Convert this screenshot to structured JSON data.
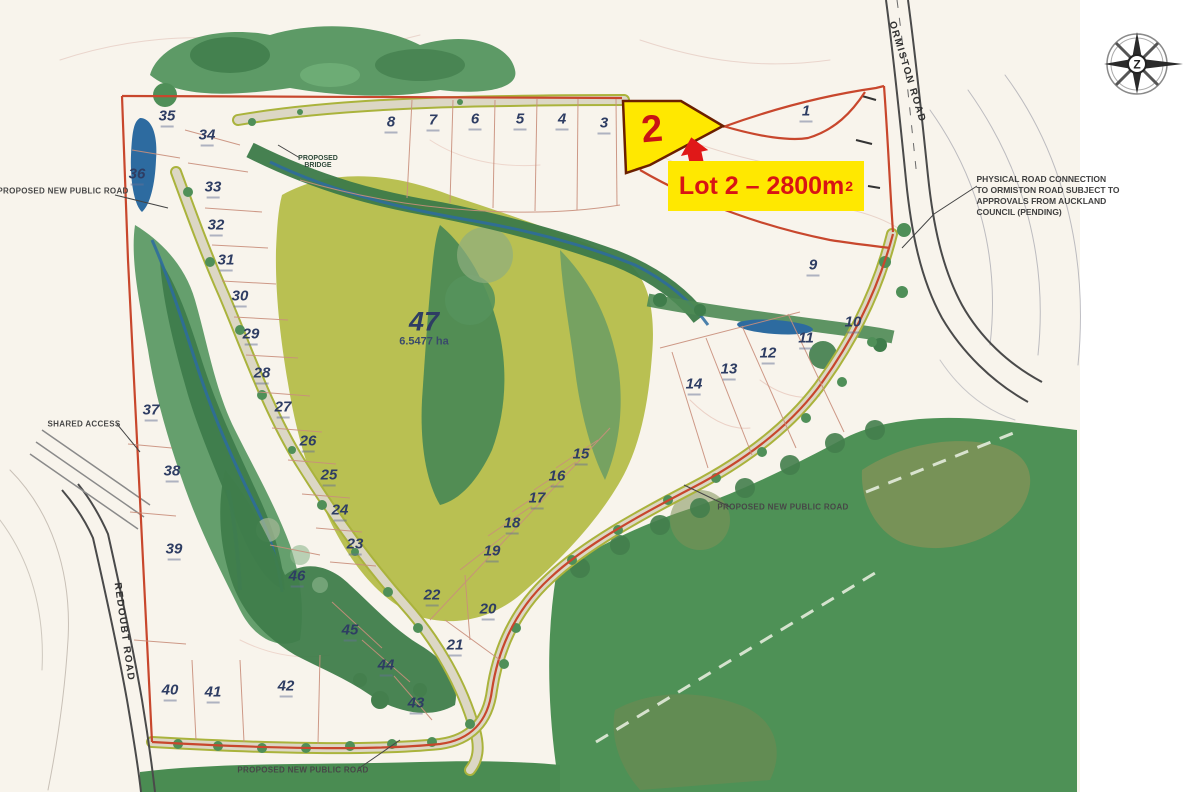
{
  "colors": {
    "paper": "#f8f4ec",
    "boundary_red": "#c8472d",
    "lot_number_navy": "#2e3d63",
    "highlight_yellow": "#ffe800",
    "highlight_red": "#d81414",
    "open_space_olive": "#b9c052",
    "forest_green": "#4e9156",
    "water_blue": "#2d6ba0",
    "road_tan": "#dcd7c5",
    "road_edge_olive": "#aab33c"
  },
  "compass": {
    "center_letter": "Z"
  },
  "highlight": {
    "number": "2",
    "label_text": "Lot 2 – 2800m",
    "label_sup": "2"
  },
  "map_labels": [
    {
      "text": "PROPOSED NEW PUBLIC ROAD",
      "x": 63,
      "y": 191,
      "cls": "tiny"
    },
    {
      "text": "SHARED ACCESS",
      "x": 84,
      "y": 424,
      "cls": "tiny"
    },
    {
      "text": "PROPOSED NEW PUBLIC ROAD",
      "x": 783,
      "y": 507,
      "cls": "tiny"
    },
    {
      "text": "PROPOSED NEW PUBLIC ROAD",
      "x": 303,
      "y": 770,
      "cls": "tiny"
    },
    {
      "text": "PROPOSED\nBRIDGE",
      "x": 318,
      "y": 162,
      "cls": "micro"
    },
    {
      "text": "ORMISTON ROAD",
      "x": 907,
      "y": 72,
      "rot": 73,
      "cls": "roadname"
    },
    {
      "text": "REDOUBT ROAD",
      "x": 124,
      "y": 632,
      "rot": 82,
      "cls": "roadname"
    },
    {
      "text": "PHYSICAL ROAD CONNECTION\nTO ORMISTON ROAD SUBJECT TO\nAPPROVALS FROM AUCKLAND\nCOUNCIL (PENDING)",
      "x": 1048,
      "y": 196,
      "cls": "note"
    }
  ],
  "lots": [
    {
      "n": "1",
      "x": 806,
      "y": 113
    },
    {
      "n": "3",
      "x": 604,
      "y": 125
    },
    {
      "n": "4",
      "x": 562,
      "y": 121
    },
    {
      "n": "5",
      "x": 520,
      "y": 121
    },
    {
      "n": "6",
      "x": 475,
      "y": 121
    },
    {
      "n": "7",
      "x": 433,
      "y": 122
    },
    {
      "n": "8",
      "x": 391,
      "y": 124
    },
    {
      "n": "9",
      "x": 813,
      "y": 267
    },
    {
      "n": "10",
      "x": 853,
      "y": 324
    },
    {
      "n": "11",
      "x": 806,
      "y": 340
    },
    {
      "n": "12",
      "x": 768,
      "y": 355
    },
    {
      "n": "13",
      "x": 729,
      "y": 371
    },
    {
      "n": "14",
      "x": 694,
      "y": 386
    },
    {
      "n": "15",
      "x": 581,
      "y": 456
    },
    {
      "n": "16",
      "x": 557,
      "y": 478
    },
    {
      "n": "17",
      "x": 537,
      "y": 500
    },
    {
      "n": "18",
      "x": 512,
      "y": 525
    },
    {
      "n": "19",
      "x": 492,
      "y": 553
    },
    {
      "n": "20",
      "x": 488,
      "y": 611
    },
    {
      "n": "21",
      "x": 455,
      "y": 647
    },
    {
      "n": "22",
      "x": 432,
      "y": 597
    },
    {
      "n": "23",
      "x": 355,
      "y": 546
    },
    {
      "n": "24",
      "x": 340,
      "y": 512
    },
    {
      "n": "25",
      "x": 329,
      "y": 477
    },
    {
      "n": "26",
      "x": 308,
      "y": 443
    },
    {
      "n": "27",
      "x": 283,
      "y": 409
    },
    {
      "n": "28",
      "x": 262,
      "y": 375
    },
    {
      "n": "29",
      "x": 251,
      "y": 336
    },
    {
      "n": "30",
      "x": 240,
      "y": 298
    },
    {
      "n": "31",
      "x": 226,
      "y": 262
    },
    {
      "n": "32",
      "x": 216,
      "y": 227
    },
    {
      "n": "33",
      "x": 213,
      "y": 189
    },
    {
      "n": "34",
      "x": 207,
      "y": 137
    },
    {
      "n": "35",
      "x": 167,
      "y": 118
    },
    {
      "n": "36",
      "x": 137,
      "y": 176
    },
    {
      "n": "37",
      "x": 151,
      "y": 412
    },
    {
      "n": "38",
      "x": 172,
      "y": 473
    },
    {
      "n": "39",
      "x": 174,
      "y": 551
    },
    {
      "n": "40",
      "x": 170,
      "y": 692
    },
    {
      "n": "41",
      "x": 213,
      "y": 694
    },
    {
      "n": "42",
      "x": 286,
      "y": 688
    },
    {
      "n": "43",
      "x": 416,
      "y": 705
    },
    {
      "n": "44",
      "x": 386,
      "y": 667
    },
    {
      "n": "45",
      "x": 350,
      "y": 632
    },
    {
      "n": "46",
      "x": 297,
      "y": 578
    },
    {
      "n": "47",
      "x": 424,
      "y": 328,
      "cls": "big",
      "area": "6.5477 ha"
    }
  ]
}
